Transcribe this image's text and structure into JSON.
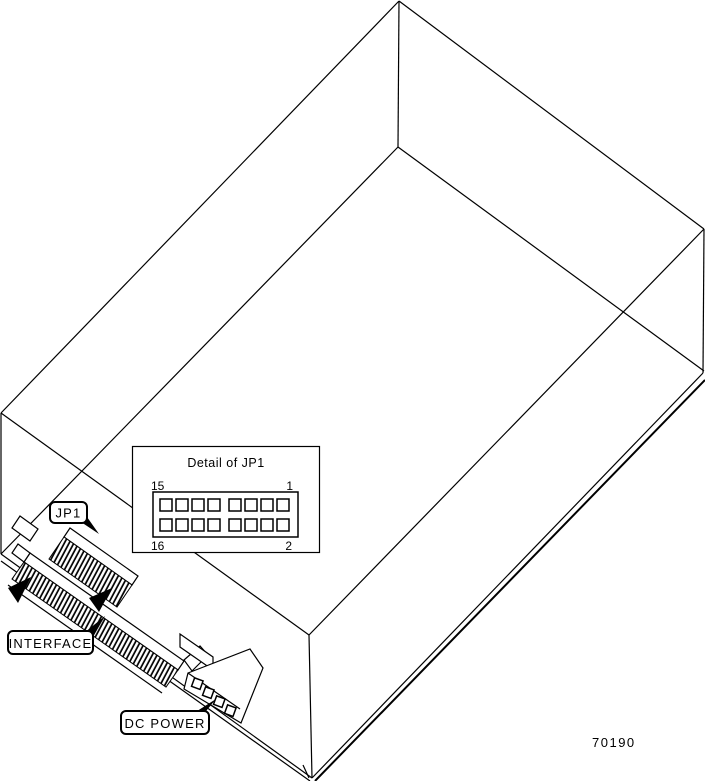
{
  "page": {
    "background": "#ffffff",
    "line_color": "#000000",
    "figure_number": "70190"
  },
  "component_callouts": {
    "jp1": {
      "label": "JP1"
    },
    "interface": {
      "label": "INTERFACE"
    },
    "dc_power": {
      "label": "DC POWER"
    }
  },
  "detail_inset": {
    "title": "Detail of JP1",
    "corner_labels": {
      "top_left": "15",
      "top_right": "1",
      "bottom_left": "16",
      "bottom_right": "2"
    },
    "pin_rows": 2,
    "pin_cols": 8
  },
  "icons": {
    "pin1_indicator": "filled-triangle-arrow",
    "callout_pointer": "filled-triangle-tail"
  }
}
